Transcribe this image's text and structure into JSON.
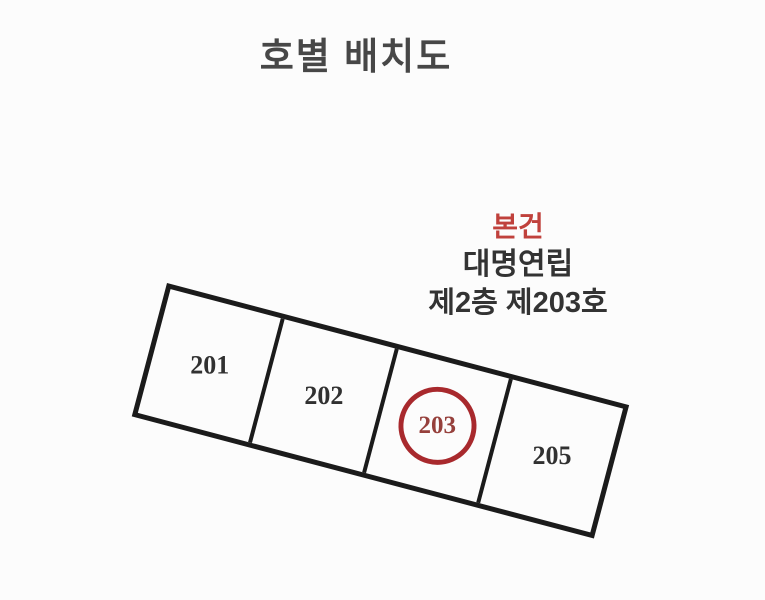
{
  "title": "호별 배치도",
  "annotation": {
    "subject_label": "본건",
    "building_name": "대명연립",
    "unit_label": "제2층 제203호"
  },
  "floorplan": {
    "rotation_deg": 14.8,
    "line_color": "#1b1b1b",
    "highlight_color": "#a8292d",
    "units": [
      {
        "label": "201",
        "highlighted": false
      },
      {
        "label": "202",
        "highlighted": false
      },
      {
        "label": "203",
        "highlighted": true
      },
      {
        "label": "205",
        "highlighted": false
      }
    ]
  },
  "colors": {
    "subject_text": "#c0413c",
    "body_text": "#333333",
    "title_text": "#474747"
  }
}
